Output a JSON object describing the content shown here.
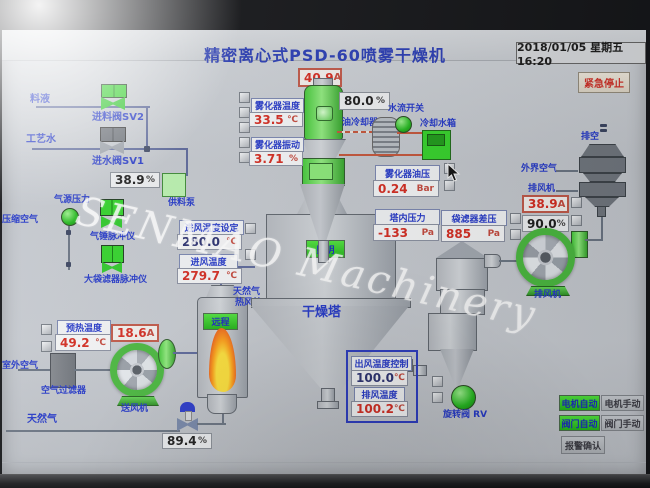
{
  "window": {
    "title": "精密离心式PSD-60喷雾干燥机",
    "datetime": "2018/01/05 星期五 16:20",
    "emergency_stop": "紧急停止",
    "watermark": "SENMAO Machinery"
  },
  "left": {
    "feed_label": "料液",
    "feed_valve": "进料阀SV2",
    "water_label": "工艺水",
    "water_valve": "进水阀SV1",
    "pump_speed": {
      "value": "38.9",
      "unit": "%"
    },
    "feed_pump": "供料泵",
    "air_pressure": "气源压力",
    "compressed_air": "压缩空气",
    "hammer_pulse": "气锤脉冲仪",
    "bag_pulse": "大袋滤器脉冲仪",
    "preheat": {
      "label": "预热温度",
      "value": "49.2",
      "unit": "℃"
    },
    "fan_current": {
      "value": "18.6",
      "unit": "A"
    },
    "air_filter": "空气过滤器",
    "supply_fan": "送风机",
    "outside_air": "室外空气",
    "natural_gas": "天然气",
    "gas_valve": {
      "value": "89.4",
      "unit": "%"
    }
  },
  "center": {
    "atomizer_current": {
      "value": "40.9",
      "unit": "A"
    },
    "atomizer_speed": {
      "value": "80.0",
      "unit": "%"
    },
    "atomizer_temp": {
      "label": "雾化器温度",
      "value": "33.5",
      "unit": "℃"
    },
    "atomizer_vib": {
      "label": "雾化器振动",
      "value": "3.71",
      "unit": "%"
    },
    "oil_cooler": "油冷却器",
    "water_flow": "水流开关",
    "cooling_tank": "冷却水箱",
    "oil_pressure": {
      "label": "雾化器油压",
      "value": "0.24",
      "unit": "Bar"
    },
    "tower_pressure": {
      "label": "塔内压力",
      "value": "-133",
      "unit": "Pa"
    },
    "bag_dp": {
      "label": "袋滤器差压",
      "value": "885",
      "unit": "Pa"
    },
    "inlet_set": {
      "label": "进风温度设定",
      "value": "280.0",
      "unit": "℃"
    },
    "inlet_temp": {
      "label": "进风温度",
      "value": "279.7",
      "unit": "℃"
    },
    "tower": "干燥塔",
    "light_btn": "照明",
    "remote_btn": "远程",
    "furnace_gas": "天然气",
    "furnace": "热风炉"
  },
  "right": {
    "outlet_ctrl": {
      "label": "出风温度控制",
      "value": "100.0",
      "unit": "℃"
    },
    "exhaust_temp": {
      "label": "排风温度",
      "value": "100.2",
      "unit": "℃"
    },
    "rotary_valve": "旋转阀 RV",
    "outside_air": "外界空气",
    "fan_label_top": "排风机",
    "exhaust_current": {
      "value": "38.9",
      "unit": "A"
    },
    "exhaust_speed": {
      "value": "90.0",
      "unit": "%"
    },
    "fan_label": "排风机",
    "vent": "排空"
  },
  "buttons": {
    "motor_auto": "电机自动",
    "motor_manual": "电机手动",
    "valve_auto": "阀门自动",
    "valve_manual": "阀门手动",
    "alarm_ack": "报警确认"
  },
  "colors": {
    "label_blue": "#2438c8",
    "value_red": "#d42b20",
    "device_green": "#35d32a",
    "screen_bg": "#c6cad0"
  }
}
